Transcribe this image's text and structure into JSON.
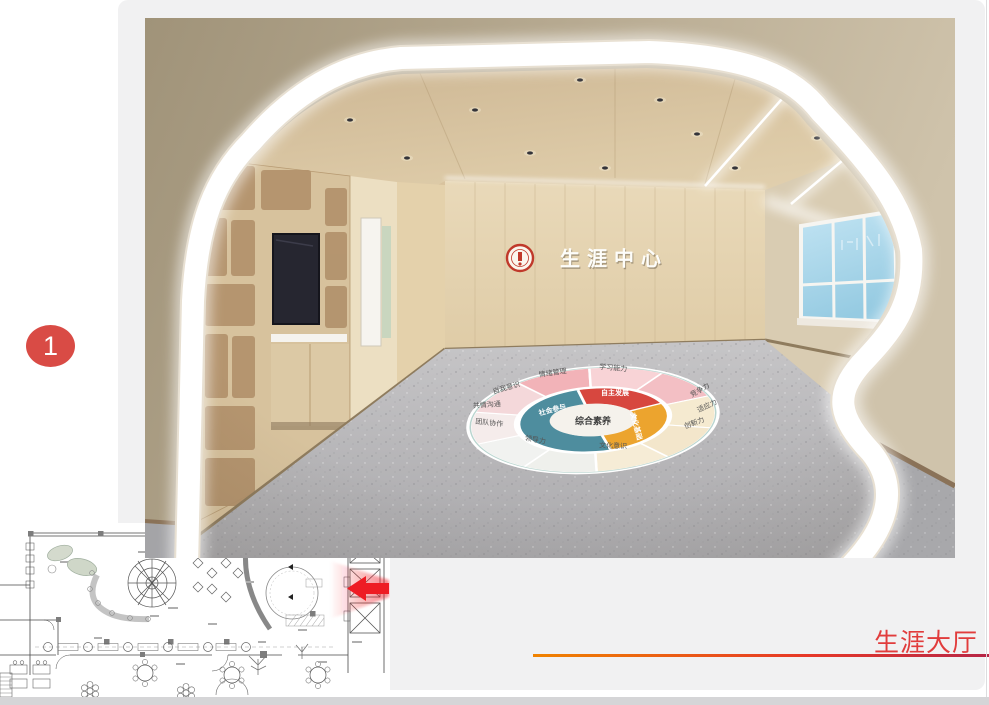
{
  "slide": {
    "number_badge": "1",
    "caption": "生涯大厅",
    "caption_color": "#e13c3c",
    "underline_gradient": [
      "#f08300",
      "#e60012"
    ],
    "card_color": "#f1f1f2",
    "badge_color": "#d94b45"
  },
  "rendering": {
    "wall_sign_text": "生涯中心",
    "seal_icon": "school-seal-icon",
    "floor_wheel": {
      "center_label": "综合素养",
      "inner_segments": [
        {
          "label": "自主发展",
          "color": "#d7473f"
        },
        {
          "label": "文化基础",
          "color": "#eca42e"
        },
        {
          "label": "社会参与",
          "color": "#4e8d9e"
        }
      ],
      "outer_labels": [
        "情绪管理",
        "学习能力",
        "自我意识",
        "共情沟通",
        "团队协作",
        "领导力",
        "文化意识",
        "竞争力",
        "适应力",
        "创新力"
      ]
    }
  },
  "floor_plan": {
    "arrow_color": "#ee1c24"
  }
}
